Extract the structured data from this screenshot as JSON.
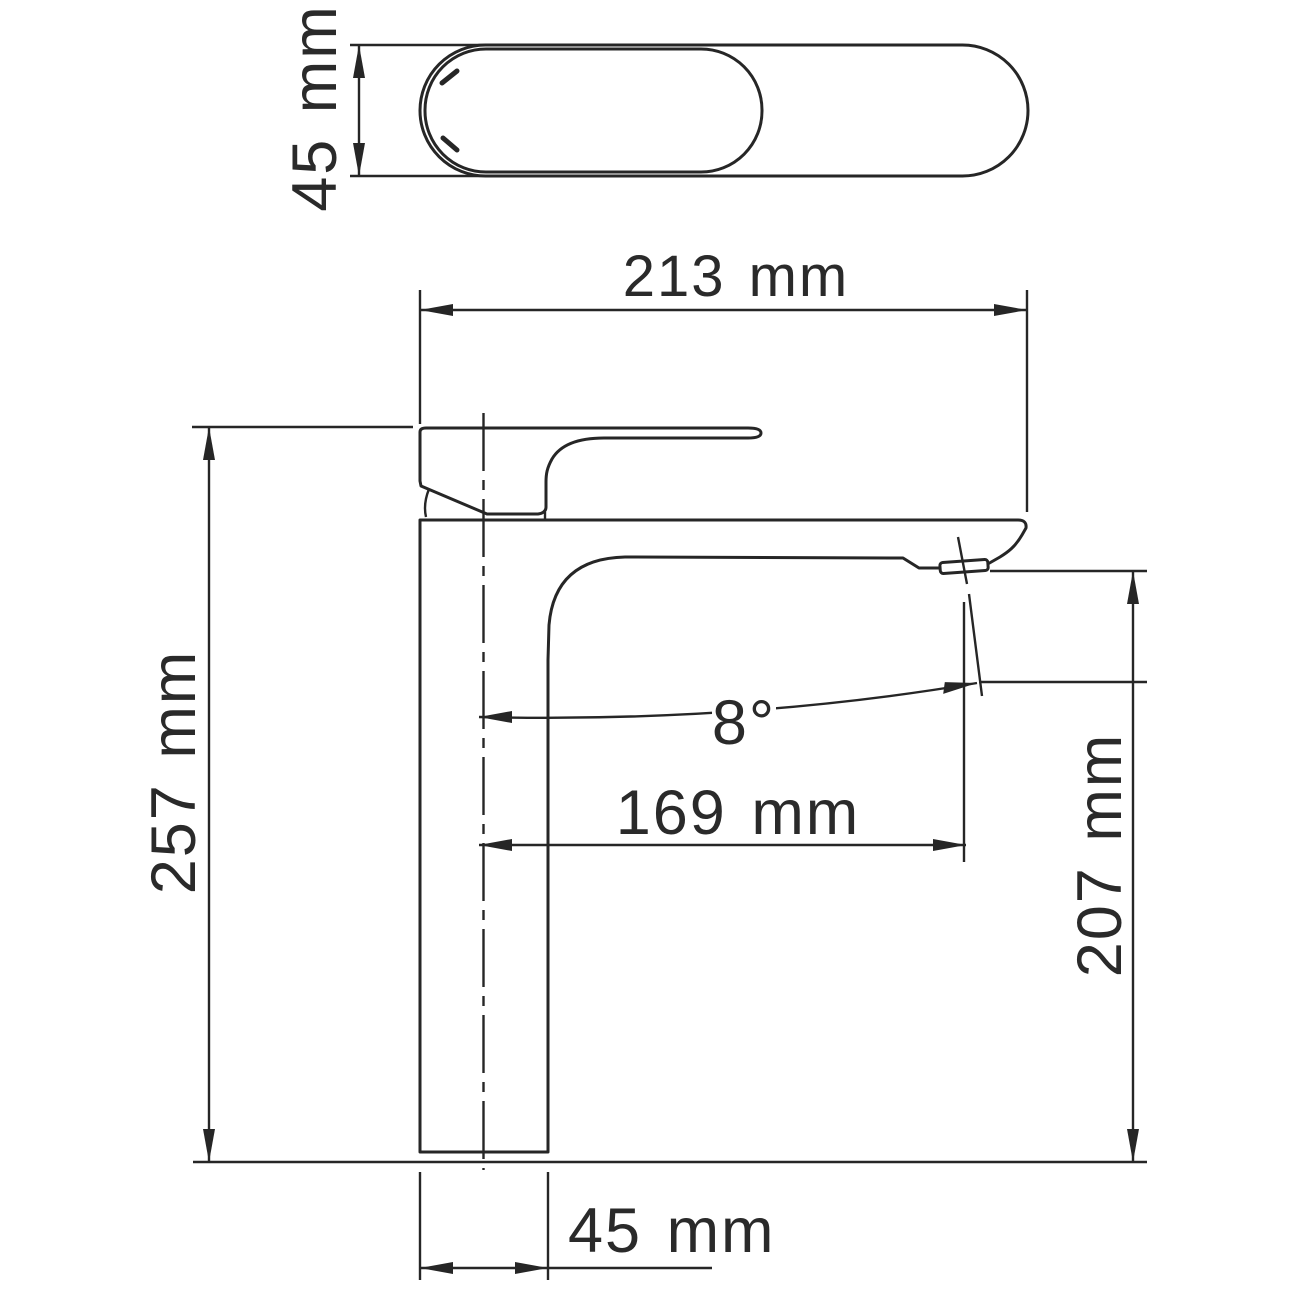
{
  "title": "Single-hole tall basin faucet — dimensional technical drawing",
  "colors": {
    "line": "#262626",
    "background": "#ffffff"
  },
  "views": {
    "top_view": {
      "name": "spout and handle top view"
    },
    "side_view": {
      "name": "faucet side elevation view"
    }
  },
  "dimensions": [
    {
      "id": "top-body-width",
      "label": "45 mm",
      "value": 45,
      "unit": "mm",
      "view": "top",
      "orientation": "vertical"
    },
    {
      "id": "overall-length",
      "label": "213 mm",
      "value": 213,
      "unit": "mm",
      "view": "side",
      "orientation": "horizontal"
    },
    {
      "id": "overall-height",
      "label": "257 mm",
      "value": 257,
      "unit": "mm",
      "view": "side",
      "orientation": "vertical"
    },
    {
      "id": "spout-angle",
      "label": "8°",
      "value": 8,
      "unit": "deg",
      "view": "side",
      "orientation": "angular"
    },
    {
      "id": "spout-reach",
      "label": "169 mm",
      "value": 169,
      "unit": "mm",
      "view": "side",
      "orientation": "horizontal"
    },
    {
      "id": "outlet-height",
      "label": "207 mm",
      "value": 207,
      "unit": "mm",
      "view": "side",
      "orientation": "vertical"
    },
    {
      "id": "base-width",
      "label": "45 mm",
      "value": 45,
      "unit": "mm",
      "view": "side",
      "orientation": "horizontal"
    }
  ]
}
